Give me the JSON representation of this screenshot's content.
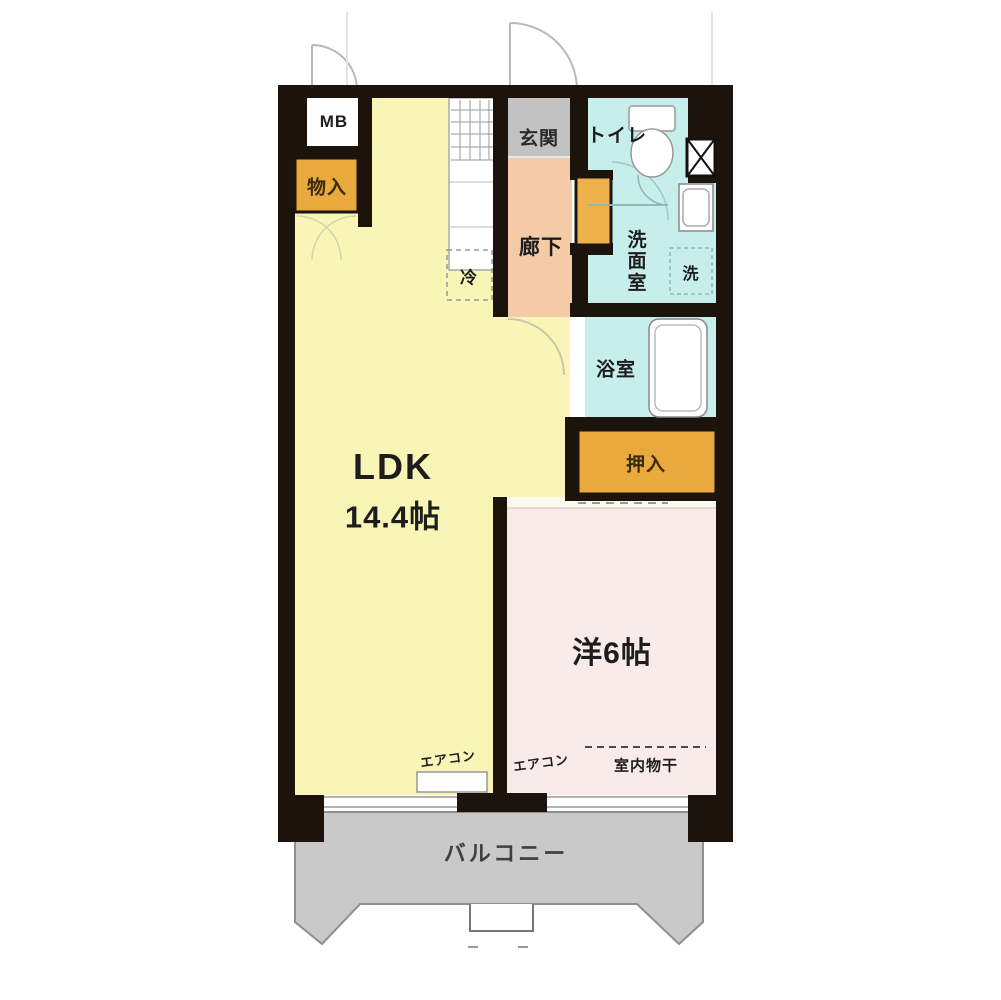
{
  "floorplan": {
    "type": "apartment-floor-plan",
    "labels": {
      "mb": "MB",
      "storage": "物入",
      "ldk_name": "LDK",
      "ldk_size": "14.4帖",
      "entrance": "玄関",
      "toilet": "トイレ",
      "corridor": "廊下",
      "washroom": "洗面室",
      "laundry": "洗",
      "bath": "浴室",
      "closet": "押入",
      "fridge": "冷",
      "western_room": "洋6帖",
      "aircon_ldk": "エアコン",
      "aircon_western": "エアコン",
      "indoor_drying": "室内物干",
      "balcony": "バルコニー"
    },
    "colors": {
      "wall": "#1c140c",
      "ldk_fill": "#f8f5b6",
      "western_fill": "#f8ebea",
      "wet_area_fill": "#c6eeea",
      "entrance_fill": "#c2c2c2",
      "corridor_fill": "#f4cba6",
      "closet_fill": "#e9a93d",
      "door_fill": "#efb24a",
      "balcony_fill": "#c9c9c9",
      "fixture_fill": "#ffffff"
    }
  }
}
